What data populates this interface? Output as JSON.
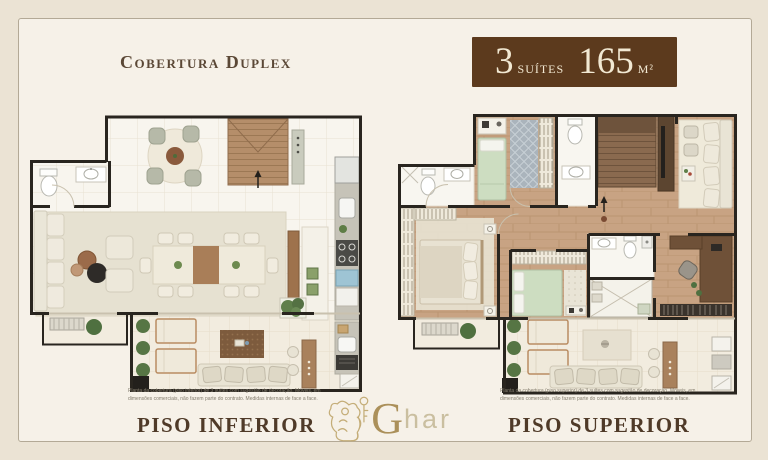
{
  "header": {
    "title": "Cobertura Duplex"
  },
  "badge": {
    "suites_value": "3",
    "suites_label": "Suítes",
    "area_value": "165",
    "area_unit": "m²"
  },
  "plans": {
    "inferior": {
      "label": "Piso Inferior",
      "disclaimer": "Planta da cobertura (piso inferior) de 3 suítes com sugestão de decoração. Móveis, em dimensões comerciais, não fazem parte do contrato. Medidas internas de face a face."
    },
    "superior": {
      "label": "Piso Superior",
      "disclaimer": "Planta da cobertura (piso superior) de 3 suítes com sugestão de decoração. Móveis, em dimensões comerciais, não fazem parte do contrato. Medidas internas de face a face."
    }
  },
  "logo": {
    "initial": "G",
    "rest": "har"
  },
  "colors": {
    "page_background": "#ebe3d4",
    "card_background": "#f6f1e8",
    "badge_background": "#5c3a1d",
    "badge_text": "#f2e9d3",
    "title_text": "#5b4836",
    "label_text": "#4f3a28",
    "logo_gold": "#ab905a",
    "plan_wall": "#29251f",
    "wood_floor": "#c8a383",
    "rug": "#e6e1d1",
    "bed_green": "#cdddc1"
  }
}
